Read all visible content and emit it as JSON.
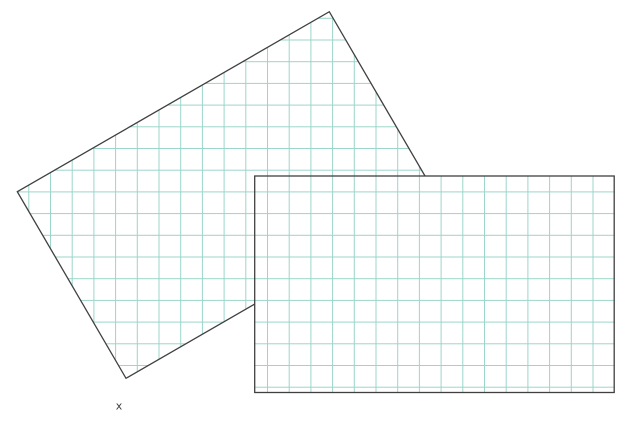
{
  "figure": {
    "background": "#ffffff",
    "outline_color": "#404040",
    "grid": {
      "line_color": "#9bd5ca",
      "spacing": 21.7,
      "offset_x": 6.6,
      "offset_y": 17.8
    },
    "shapes": {
      "rotated_rect": {
        "name": "rotated grid rectangle",
        "points": "17.3,191.7 329.3,11.7 438,198.3 126,378.3",
        "fill": "#ffffff"
      },
      "front_rect": {
        "name": "axis-aligned grid rectangle",
        "x": 254.7,
        "y": 176,
        "width": 359.5,
        "height": 216.5,
        "fill": "#ffffff"
      }
    },
    "marker": {
      "label": "x",
      "x": 119,
      "y": 409.5,
      "color": "#3d3d3d"
    }
  }
}
